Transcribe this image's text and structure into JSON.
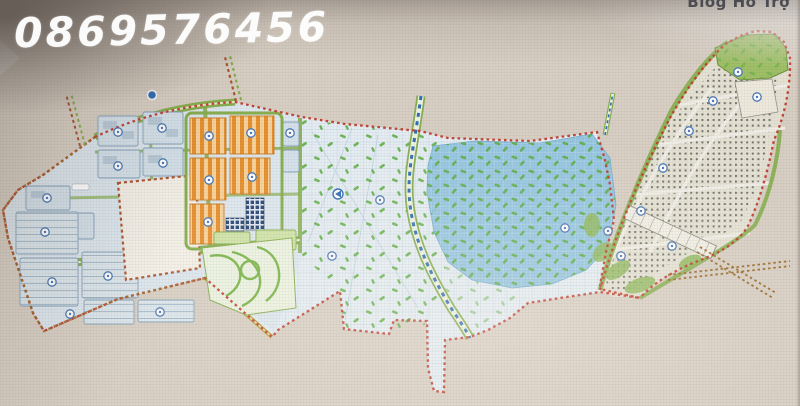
{
  "watermark": {
    "phone": "0869576456"
  },
  "header": {
    "support_label": "Blog Hỗ Trợ"
  },
  "palette": {
    "paper": "#d8cfc4",
    "paper_light": "#ece4d8",
    "header_band": "#f4f1ec",
    "header_text": "#43434b",
    "watermark": "#ffffff",
    "boundary_red": "#c03a2c",
    "boundary_brown": "#9c6c2c",
    "road_green": "#86ae4e",
    "road_green_light": "#e4eecf",
    "road_yellow": "#b5a23a",
    "block_blue": "#d4e1ea",
    "block_outline": "#84a0ba",
    "block_inner": "#b9cbd9",
    "orange_block": "#e78f2d",
    "orange_light": "#f6d29b",
    "navy_block": "#274572",
    "field_pale": "#e4edf3",
    "lake_blue": "#8fc3e0",
    "speck_green": "#58ab3c",
    "canal_blue": "#2f6db5",
    "park_fill": "#ebf2e0",
    "park_path": "#79b548",
    "arm_fill": "#e4e2d4",
    "arm_dot": "#4d4b42",
    "white_parcel": "#f3f0e8",
    "industrial_fill": "#dbe6ec",
    "symbol_blue": "#4a78b5"
  }
}
